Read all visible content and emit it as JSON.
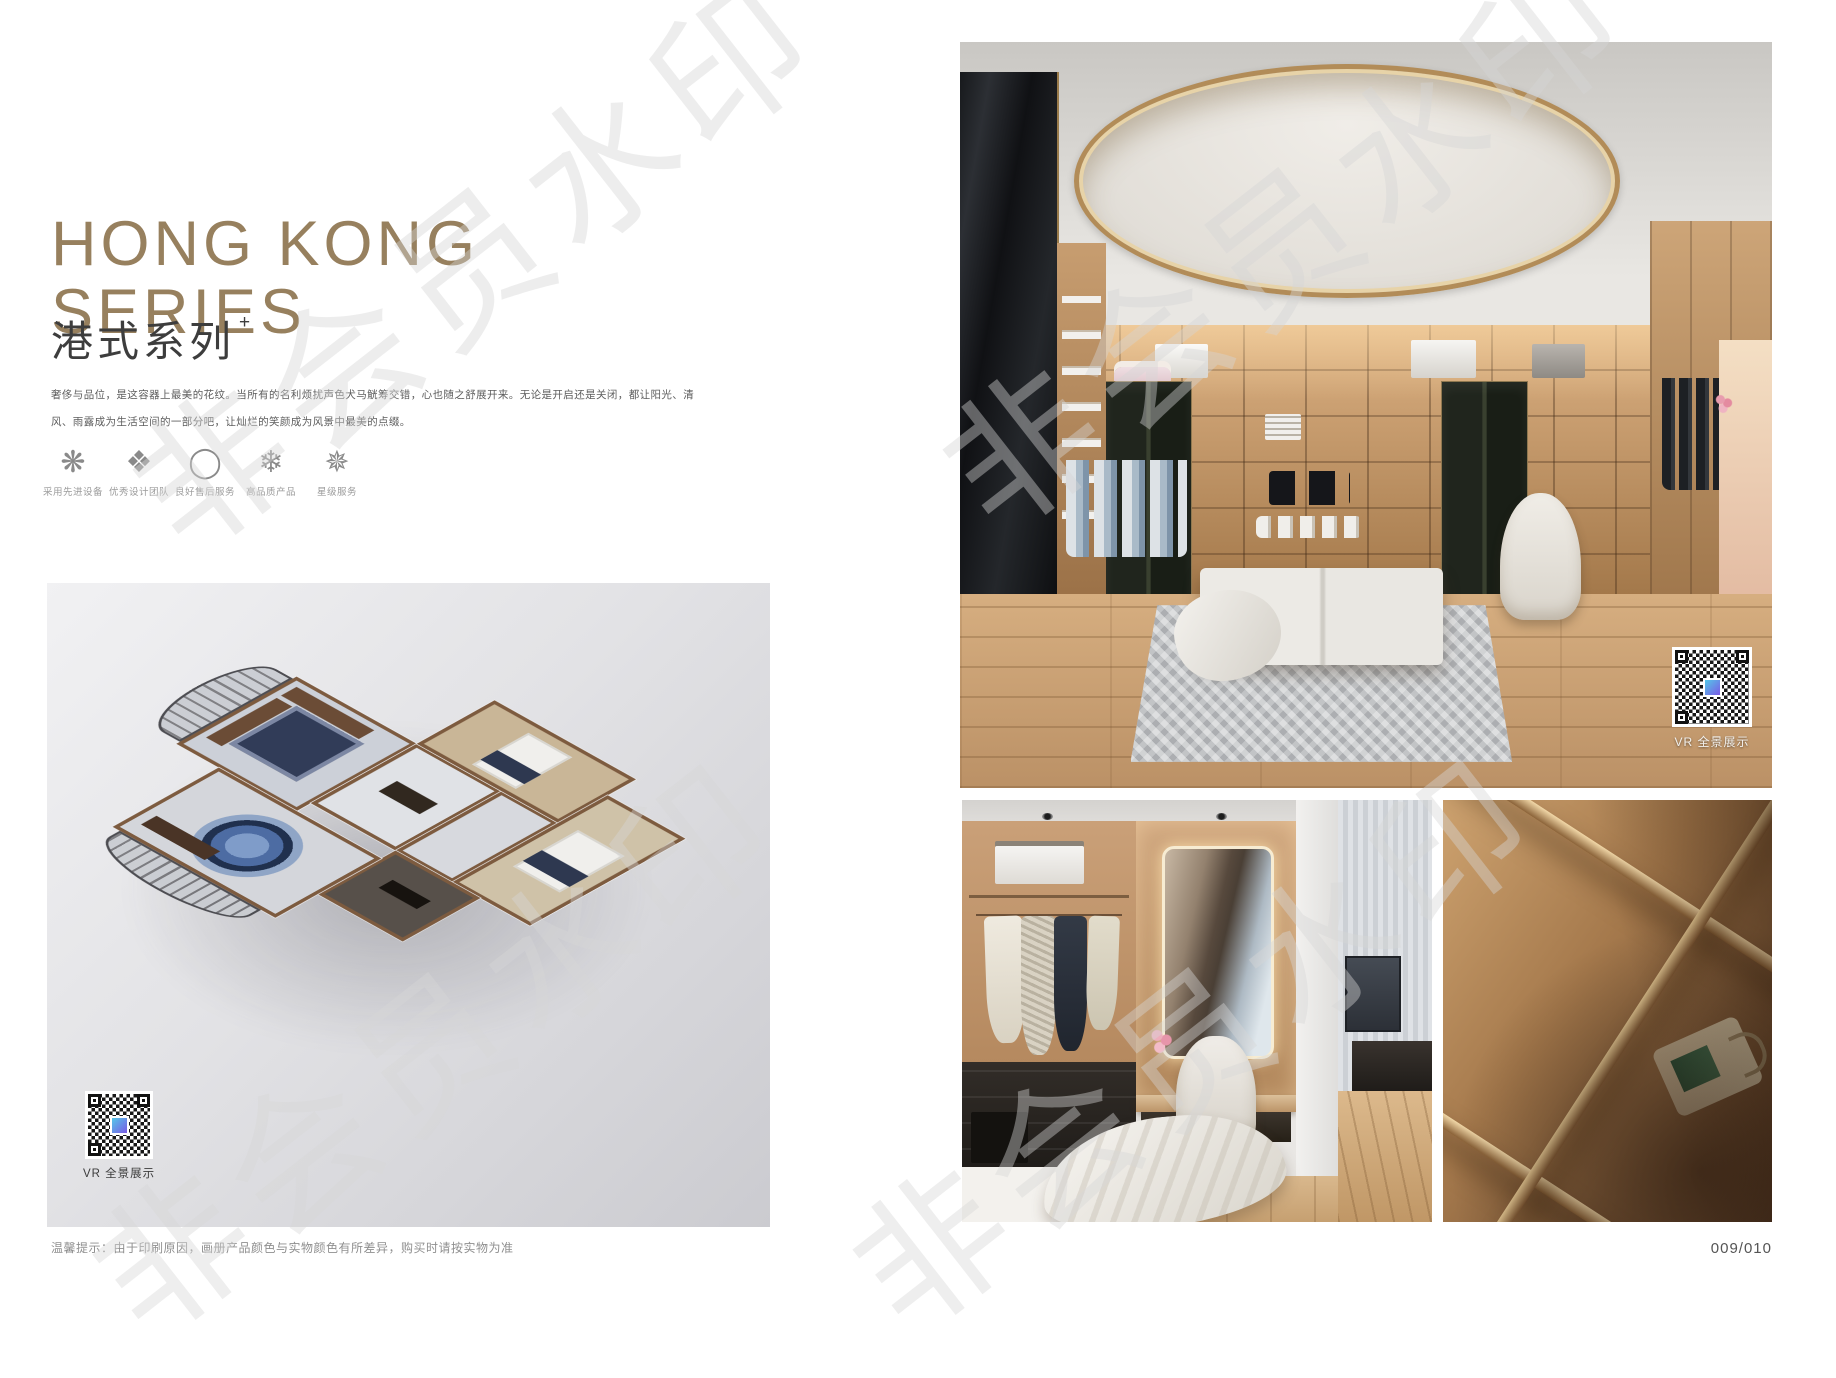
{
  "header": {
    "title_en_line1": "HONG KONG",
    "title_en_line2": "SERIES",
    "title_cn": "港式系列",
    "title_sup": "+",
    "description_line1": "奢侈与品位，是这容器上最美的花纹。当所有的名利烦扰声色犬马觥筹交错，心也随之舒展开来。无论是开启还是关闭，都让阳光、清",
    "description_line2": "风、雨露成为生活空间的一部分吧，让灿烂的笑颜成为风景中最美的点缀。"
  },
  "features": [
    {
      "icon": "pinwheel-flower-icon",
      "glyph": "❋",
      "label": "采用先进设备"
    },
    {
      "icon": "ornament-diamond-icon",
      "glyph": "❖",
      "label": "优秀设计团队"
    },
    {
      "icon": "ring-icon",
      "glyph": "◯",
      "label": "良好售后服务"
    },
    {
      "icon": "snowflake-icon",
      "glyph": "❄",
      "label": "高品质产品"
    },
    {
      "icon": "star-crown-icon",
      "glyph": "✵",
      "label": "星级服务"
    }
  ],
  "floorplan": {
    "vr_label": "VR 全景展示"
  },
  "main_photo": {
    "vr_label": "VR 全景展示"
  },
  "footer": {
    "disclaimer": "温馨提示：由于印刷原因，画册产品颜色与实物颜色有所差异，购买时请按实物为准",
    "page_number": "009/010"
  },
  "watermark": {
    "text": "非会员水印"
  },
  "colors": {
    "title_accent": "#97805e",
    "gold_ring": "#b28c58",
    "page_background": "#ffffff"
  }
}
